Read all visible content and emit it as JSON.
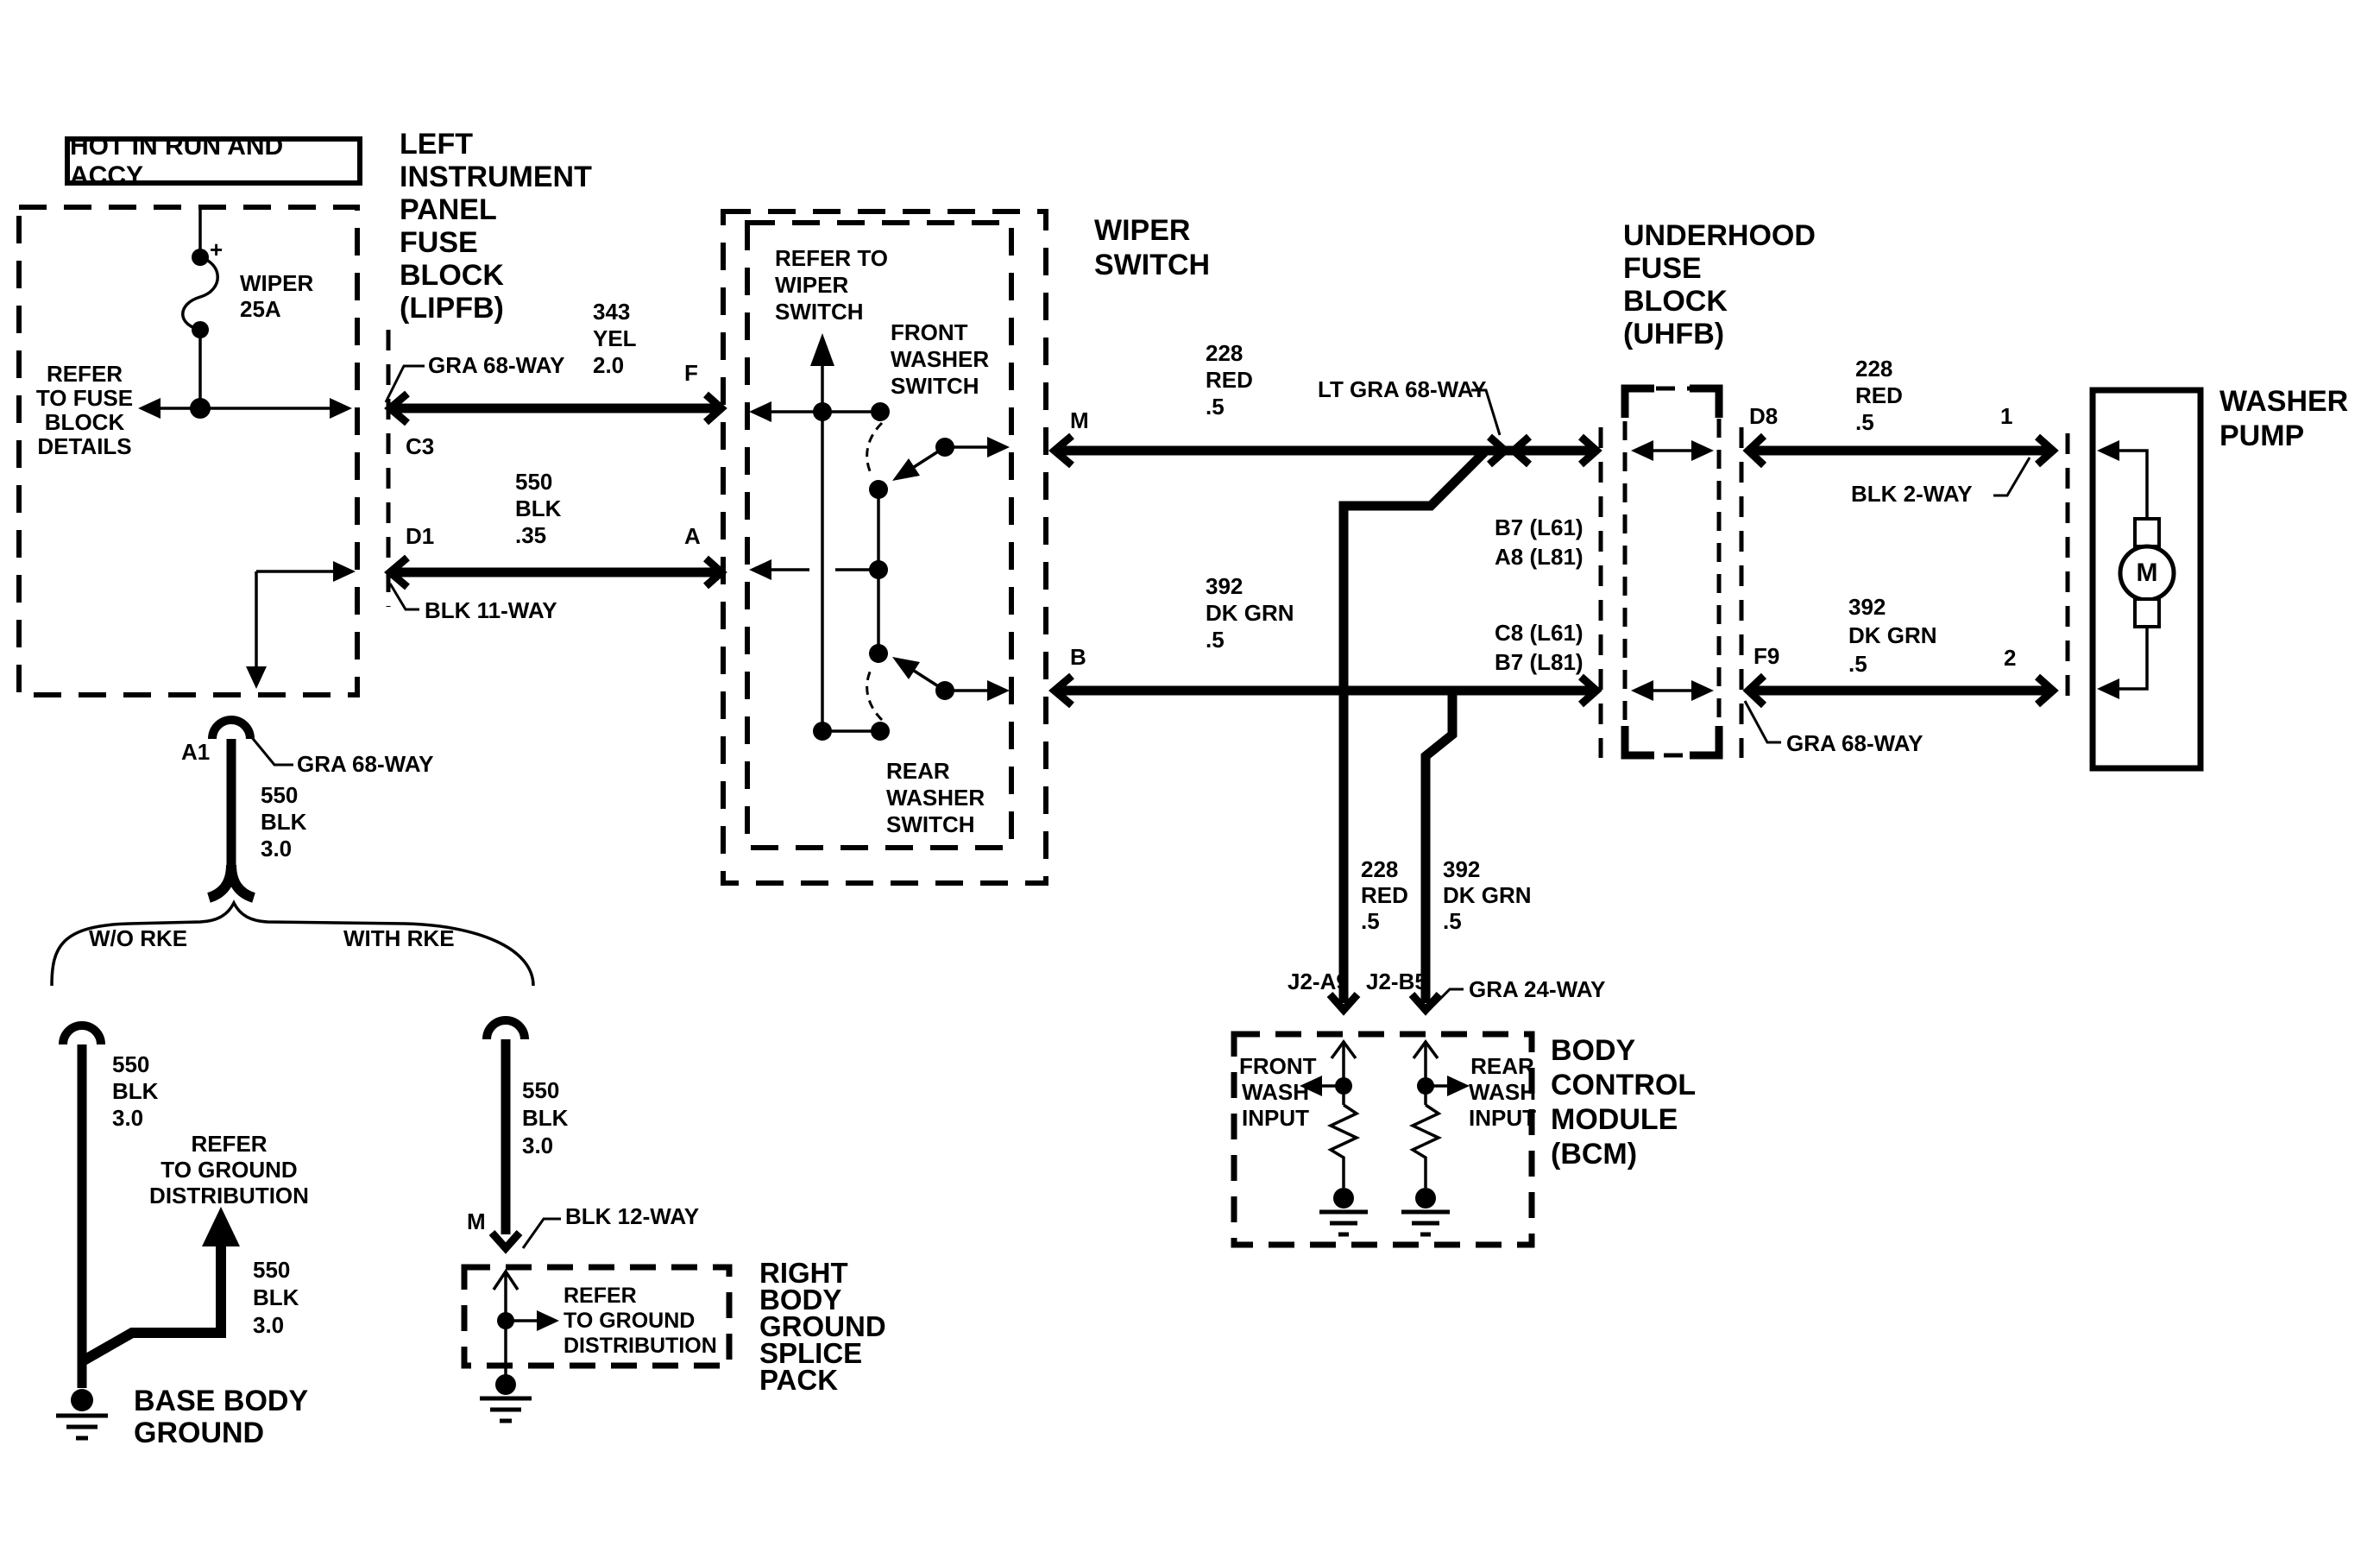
{
  "power": {
    "label": "HOT IN RUN AND ACCY"
  },
  "lipfb": {
    "title": [
      "LEFT",
      "INSTRUMENT",
      "PANEL",
      "FUSE",
      "BLOCK",
      "(LIPFB)"
    ],
    "fuse_name": "WIPER",
    "fuse_rating": "25A",
    "fuse_polarity": "+",
    "note": [
      "REFER",
      "TO FUSE",
      "BLOCK",
      "DETAILS"
    ],
    "conn_top": "C3",
    "conn_bottom": "D1",
    "conn_label": "GRA 68-WAY",
    "conn_label_bottom": "BLK 11-WAY",
    "pin_top": "F",
    "pin_bottom": "A",
    "pin_ground": "A1",
    "ground_conn_label": "GRA 68-WAY"
  },
  "wires": {
    "yel": [
      "343",
      "YEL",
      "2.0"
    ],
    "blk35": [
      "550",
      "BLK",
      ".35"
    ],
    "red_m": [
      "228",
      "RED",
      ".5"
    ],
    "grn_b": [
      "392",
      "DK GRN",
      ".5"
    ],
    "red_d8": [
      "228",
      "RED",
      ".5"
    ],
    "grn_f9": [
      "392",
      "DK GRN",
      ".5"
    ],
    "red_bcm": [
      "228",
      "RED",
      ".5"
    ],
    "grn_bcm": [
      "392",
      "DK GRN",
      ".5"
    ],
    "blk30_a1": [
      "550",
      "BLK",
      "3.0"
    ],
    "blk30_left": [
      "550",
      "BLK",
      "3.0"
    ],
    "blk30_arrow": [
      "550",
      "BLK",
      "3.0"
    ],
    "blk30_right": [
      "550",
      "BLK",
      "3.0"
    ]
  },
  "wiper_switch": {
    "title": [
      "WIPER",
      "SWITCH"
    ],
    "note": [
      "REFER TO",
      "WIPER",
      "SWITCH"
    ],
    "front": [
      "FRONT",
      "WASHER",
      "SWITCH"
    ],
    "rear": [
      "REAR",
      "WASHER",
      "SWITCH"
    ],
    "out_top": "M",
    "out_bottom": "B"
  },
  "mid": {
    "inline_conn": "LT GRA 68-WAY",
    "pins_top": [
      "B7 (L61)",
      "A8 (L81)"
    ],
    "pins_bottom": [
      "C8 (L61)",
      "B7 (L81)"
    ]
  },
  "uhfb": {
    "title": [
      "UNDERHOOD",
      "FUSE",
      "BLOCK",
      "(UHFB)"
    ],
    "pin_in_top": "D8",
    "pin_in_bottom": "F9",
    "pump_pin_top": "1",
    "pump_pin_bottom": "2",
    "conn_label_top": "BLK 2-WAY",
    "conn_label_bottom": "GRA 68-WAY"
  },
  "pump": {
    "title": [
      "WASHER",
      "PUMP"
    ],
    "motor": "M"
  },
  "bcm": {
    "title": [
      "BODY",
      "CONTROL",
      "MODULE",
      "(BCM)"
    ],
    "pin_front": "J2-A9",
    "pin_rear": "J2-B5",
    "conn_label": "GRA 24-WAY",
    "front_input": [
      "FRONT",
      "WASH",
      "INPUT"
    ],
    "rear_input": [
      "REAR",
      "WASH",
      "INPUT"
    ]
  },
  "grounds": {
    "branch_left": "W/O RKE",
    "branch_right": "WITH RKE",
    "left_note": [
      "REFER",
      "TO GROUND",
      "DISTRIBUTION"
    ],
    "left_name": [
      "BASE BODY",
      "GROUND"
    ],
    "splice_pin": "M",
    "splice_conn_label": "BLK 12-WAY",
    "splice_note": [
      "REFER",
      "TO GROUND",
      "DISTRIBUTION"
    ],
    "splice_name": [
      "RIGHT",
      "BODY",
      "GROUND",
      "SPLICE",
      "PACK"
    ]
  }
}
